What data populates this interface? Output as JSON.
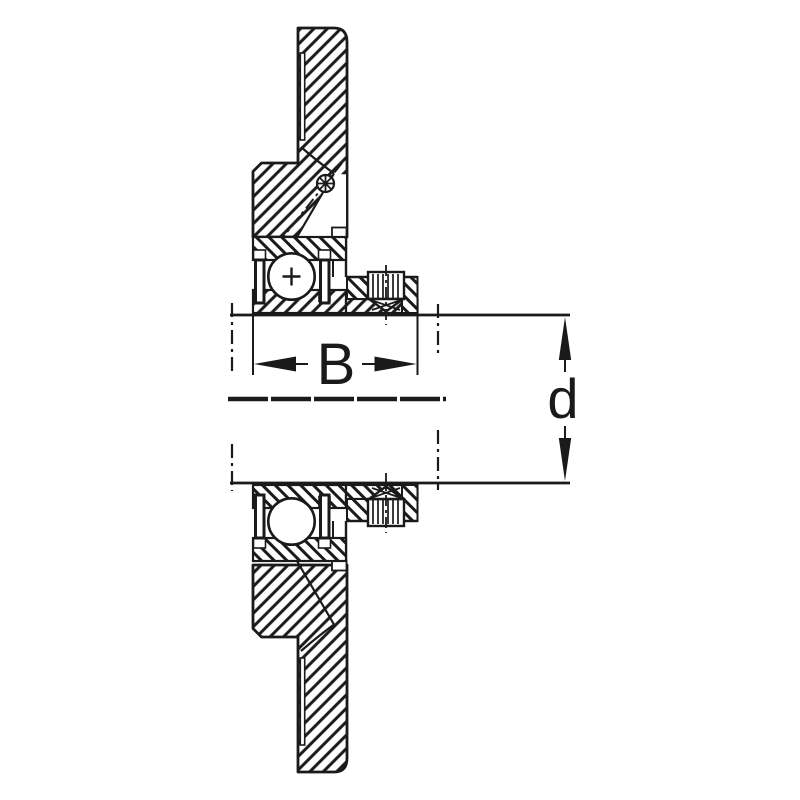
{
  "diagram": {
    "kind": "flanged-bearing-unit-cross-section",
    "dimension_labels": {
      "width": "B",
      "bore_diameter": "d"
    },
    "colors": {
      "ink": "#1a1a1a",
      "paper": "#ffffff"
    }
  }
}
